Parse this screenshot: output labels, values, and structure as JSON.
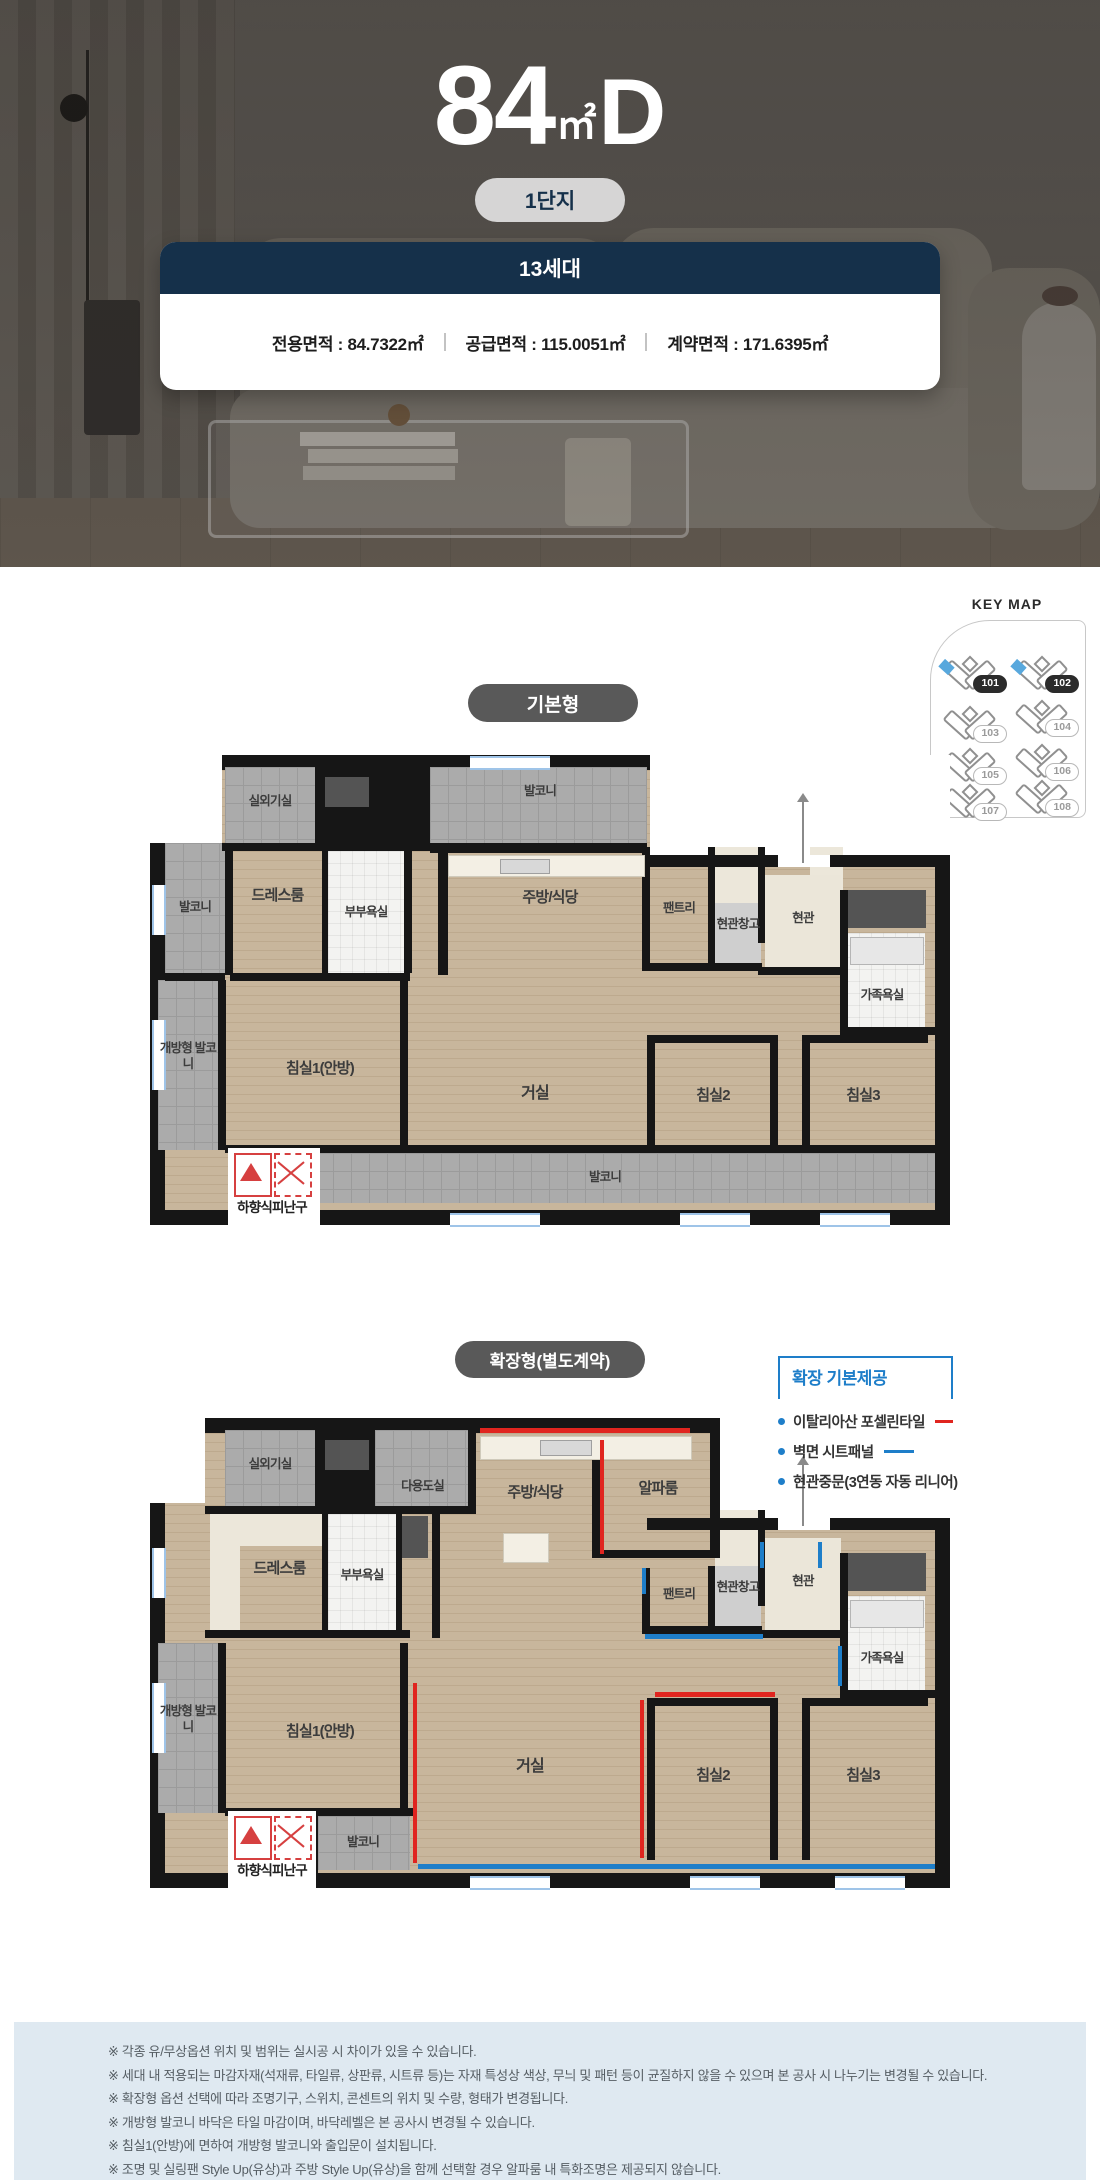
{
  "hero": {
    "unit_type": {
      "number": "84",
      "unit": "㎡",
      "letter": "D"
    },
    "complex_badge": "1단지",
    "households": "13세대",
    "areas": [
      "전용면적 : 84.7322㎡",
      "공급면적 : 115.0051㎡",
      "계약면적 : 171.6395㎡"
    ]
  },
  "keymap": {
    "title": "KEY MAP",
    "buildings": [
      {
        "id": "101",
        "highlighted": true
      },
      {
        "id": "102",
        "highlighted": true
      },
      {
        "id": "103",
        "highlighted": false
      },
      {
        "id": "104",
        "highlighted": false
      },
      {
        "id": "105",
        "highlighted": false
      },
      {
        "id": "106",
        "highlighted": false
      },
      {
        "id": "107",
        "highlighted": false
      },
      {
        "id": "108",
        "highlighted": false
      }
    ]
  },
  "plan_basic": {
    "badge": "기본형",
    "rooms": {
      "outdoor": "실외기실",
      "balcony_top": "발코니",
      "balcony_left": "발코니",
      "dress": "드레스룸",
      "couple_bath": "부부욕실",
      "kitchen": "주방/식당",
      "pantry": "팬트리",
      "entry_storage": "현관창고",
      "entry": "현관",
      "family_bath": "가족욕실",
      "open_balcony": "개방형 발코니",
      "bedroom1": "침실1(안방)",
      "living": "거실",
      "bedroom2": "침실2",
      "bedroom3": "침실3",
      "balcony_bottom": "발코니",
      "escape_hatch": "하향식피난구"
    }
  },
  "plan_extended": {
    "badge": "확장형(별도계약)",
    "rooms": {
      "outdoor": "실외기실",
      "utility": "다용도실",
      "dress": "드레스룸",
      "couple_bath": "부부욕실",
      "kitchen": "주방/식당",
      "alpha": "알파룸",
      "pantry": "팬트리",
      "entry_storage": "현관창고",
      "entry": "현관",
      "family_bath": "가족욕실",
      "open_balcony": "개방형 발코니",
      "bedroom1": "침실1(안방)",
      "living": "거실",
      "bedroom2": "침실2",
      "bedroom3": "침실3",
      "balcony_small": "발코니",
      "escape_hatch": "하향식피난구"
    }
  },
  "legend": {
    "title": "확장 기본제공",
    "items": [
      {
        "label": "이탈리아산 포셀린타일",
        "line": "red"
      },
      {
        "label": "벽면 시트패널",
        "line": "blue"
      },
      {
        "label": "현관중문(3연동 자동 리니어)",
        "line": "none"
      }
    ]
  },
  "colors": {
    "navy": "#15304a",
    "accent_red": "#e0251f",
    "accent_blue": "#1e7ec9"
  },
  "notes": [
    "※ 각종 유/무상옵션 위치 및 범위는 실시공 시 차이가 있을 수 있습니다.",
    "※ 세대 내 적용되는 마감자재(석재류, 타일류, 상판류, 시트류 등)는 자재 특성상 색상, 무늬 및 패턴 등이 균질하지 않을 수 있으며 본 공사 시 나누기는 변경될 수 있습니다.",
    "※ 확장형 옵션 선택에 따라 조명기구, 스위치, 콘센트의 위치 및 수량, 형태가 변경됩니다.",
    "※ 개방형 발코니 바닥은 타일 마감이며, 바닥레벨은 본 공사시 변경될 수 있습니다.",
    "※ 침실1(안방)에 면하여 개방형 발코니와 출입문이 설치됩니다.",
    "※ 조명 및 실링팬 Style Up(유상)과 주방 Style Up(유상)을 함께 선택할 경우 알파룸 내 특화조명은 제공되지 않습니다."
  ]
}
